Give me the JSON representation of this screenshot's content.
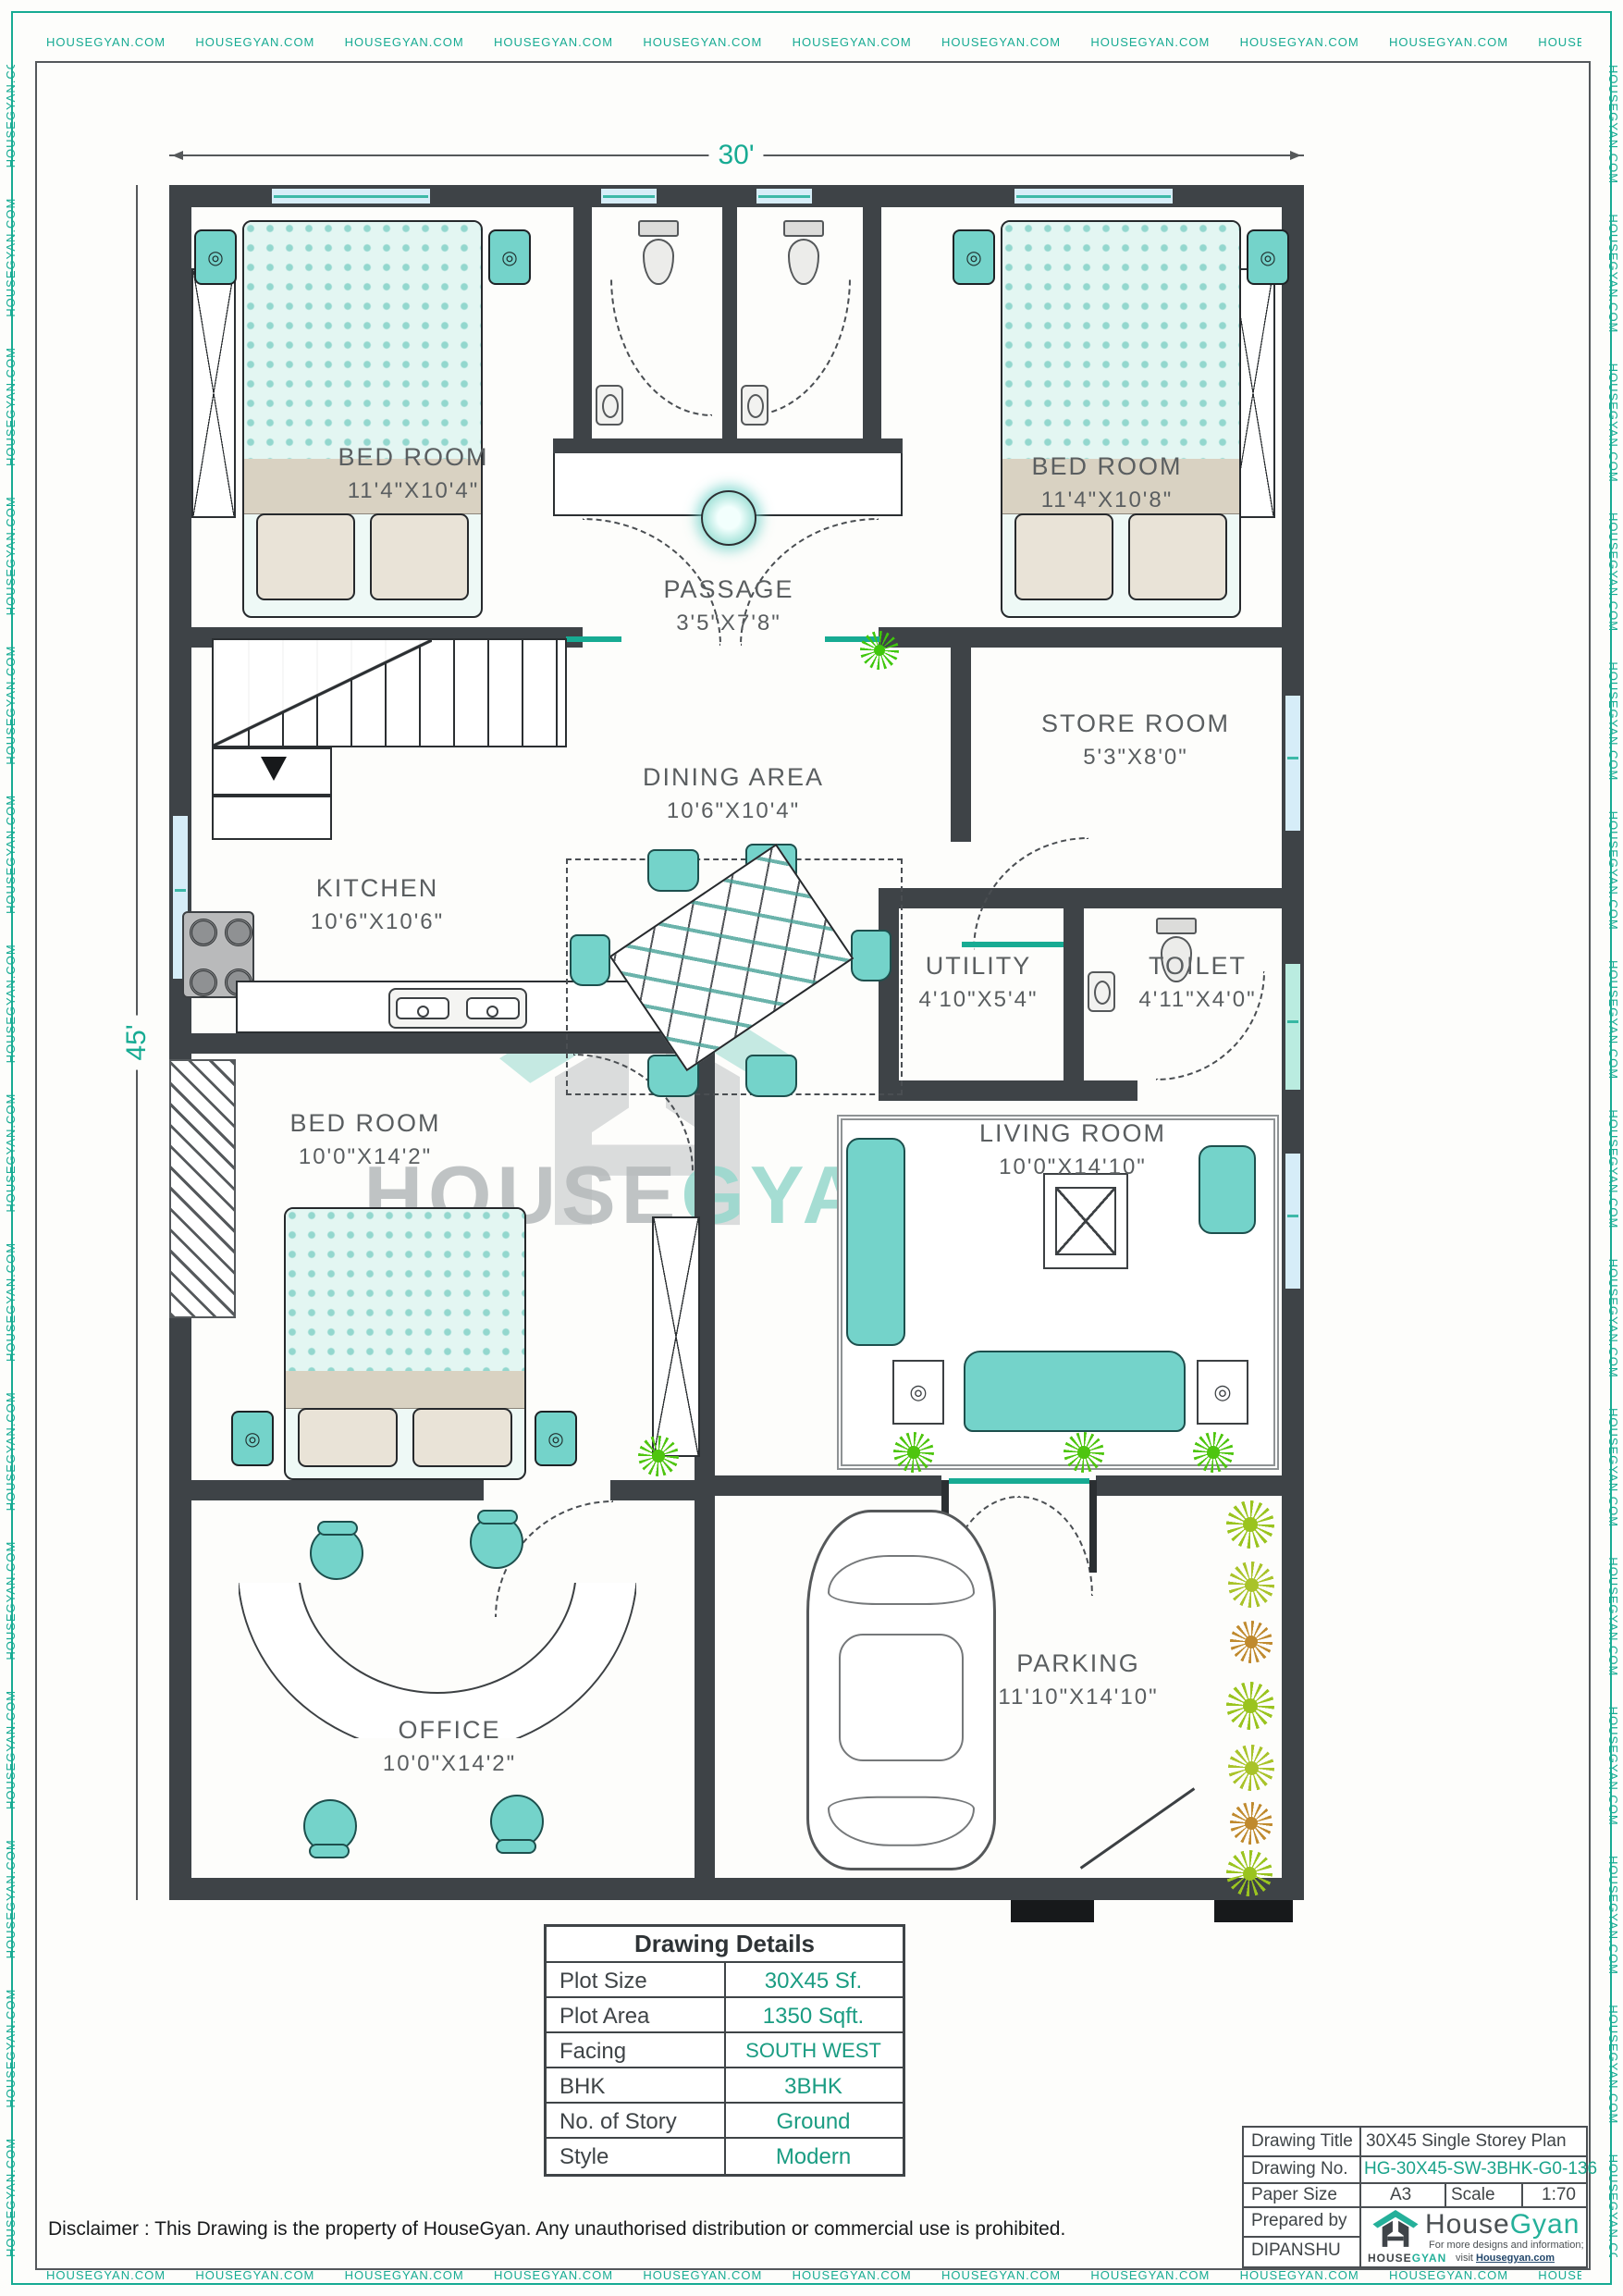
{
  "border": {
    "watermark": "HOUSEGYAN.COM"
  },
  "dimensions": {
    "width": "30'",
    "height": "45'"
  },
  "rooms": [
    {
      "name": "BED ROOM",
      "size": "11'4\"X10'4\""
    },
    {
      "name": "BED ROOM",
      "size": "11'4\"X10'8\""
    },
    {
      "name": "PASSAGE",
      "size": "3'5\"X7'8\""
    },
    {
      "name": "STORE ROOM",
      "size": "5'3\"X8'0\""
    },
    {
      "name": "DINING AREA",
      "size": "10'6\"X10'4\""
    },
    {
      "name": "KITCHEN",
      "size": "10'6\"X10'6\""
    },
    {
      "name": "UTILITY",
      "size": "4'10\"X5'4\""
    },
    {
      "name": "TOILET",
      "size": "4'11\"X4'0\""
    },
    {
      "name": "BED ROOM",
      "size": "10'0\"X14'2\""
    },
    {
      "name": "LIVING ROOM",
      "size": "10'0\"X14'10\""
    },
    {
      "name": "OFFICE",
      "size": "10'0\"X14'2\""
    },
    {
      "name": "PARKING",
      "size": "11'10\"X14'10\""
    }
  ],
  "watermark_center": {
    "part1": "HOUSE",
    "part2": "GYAN"
  },
  "drawing_details": {
    "title": "Drawing Details",
    "rows": [
      {
        "label": "Plot Size",
        "value": "30X45 Sf."
      },
      {
        "label": "Plot Area",
        "value": "1350 Sqft."
      },
      {
        "label": "Facing",
        "value": "SOUTH WEST"
      },
      {
        "label": "BHK",
        "value": "3BHK"
      },
      {
        "label": "No. of Story",
        "value": "Ground"
      },
      {
        "label": "Style",
        "value": "Modern"
      }
    ]
  },
  "title_block": {
    "drawing_title_label": "Drawing Title",
    "drawing_title": "30X45 Single Storey Plan",
    "drawing_no_label": "Drawing No.",
    "drawing_no": "HG-30X45-SW-3BHK-G0-136",
    "paper_size_label": "Paper Size",
    "paper_size": "A3",
    "scale_label": "Scale",
    "scale": "1:70",
    "prepared_by_label": "Prepared by",
    "prepared_by": "DIPANSHU",
    "brand": {
      "name_part1": "House",
      "name_part2": "Gyan",
      "tagline_line1": "For more designs and information;",
      "tagline_line2": "visit",
      "tagline_link": "Housegyan.com",
      "logo_caption_part1": "HOUSE",
      "logo_caption_part2": "GYAN"
    }
  },
  "disclaimer": "Disclaimer : This Drawing is the property of HouseGyan. Any unauthorised distribution or commercial use is prohibited.",
  "colors": {
    "accent": "#17ab93",
    "wall": "#3e4347",
    "furniture": "#74d3ca",
    "window_blue": "#d6edf8",
    "value_green": "#1a9c82",
    "label_gray": "#5a5e60"
  }
}
